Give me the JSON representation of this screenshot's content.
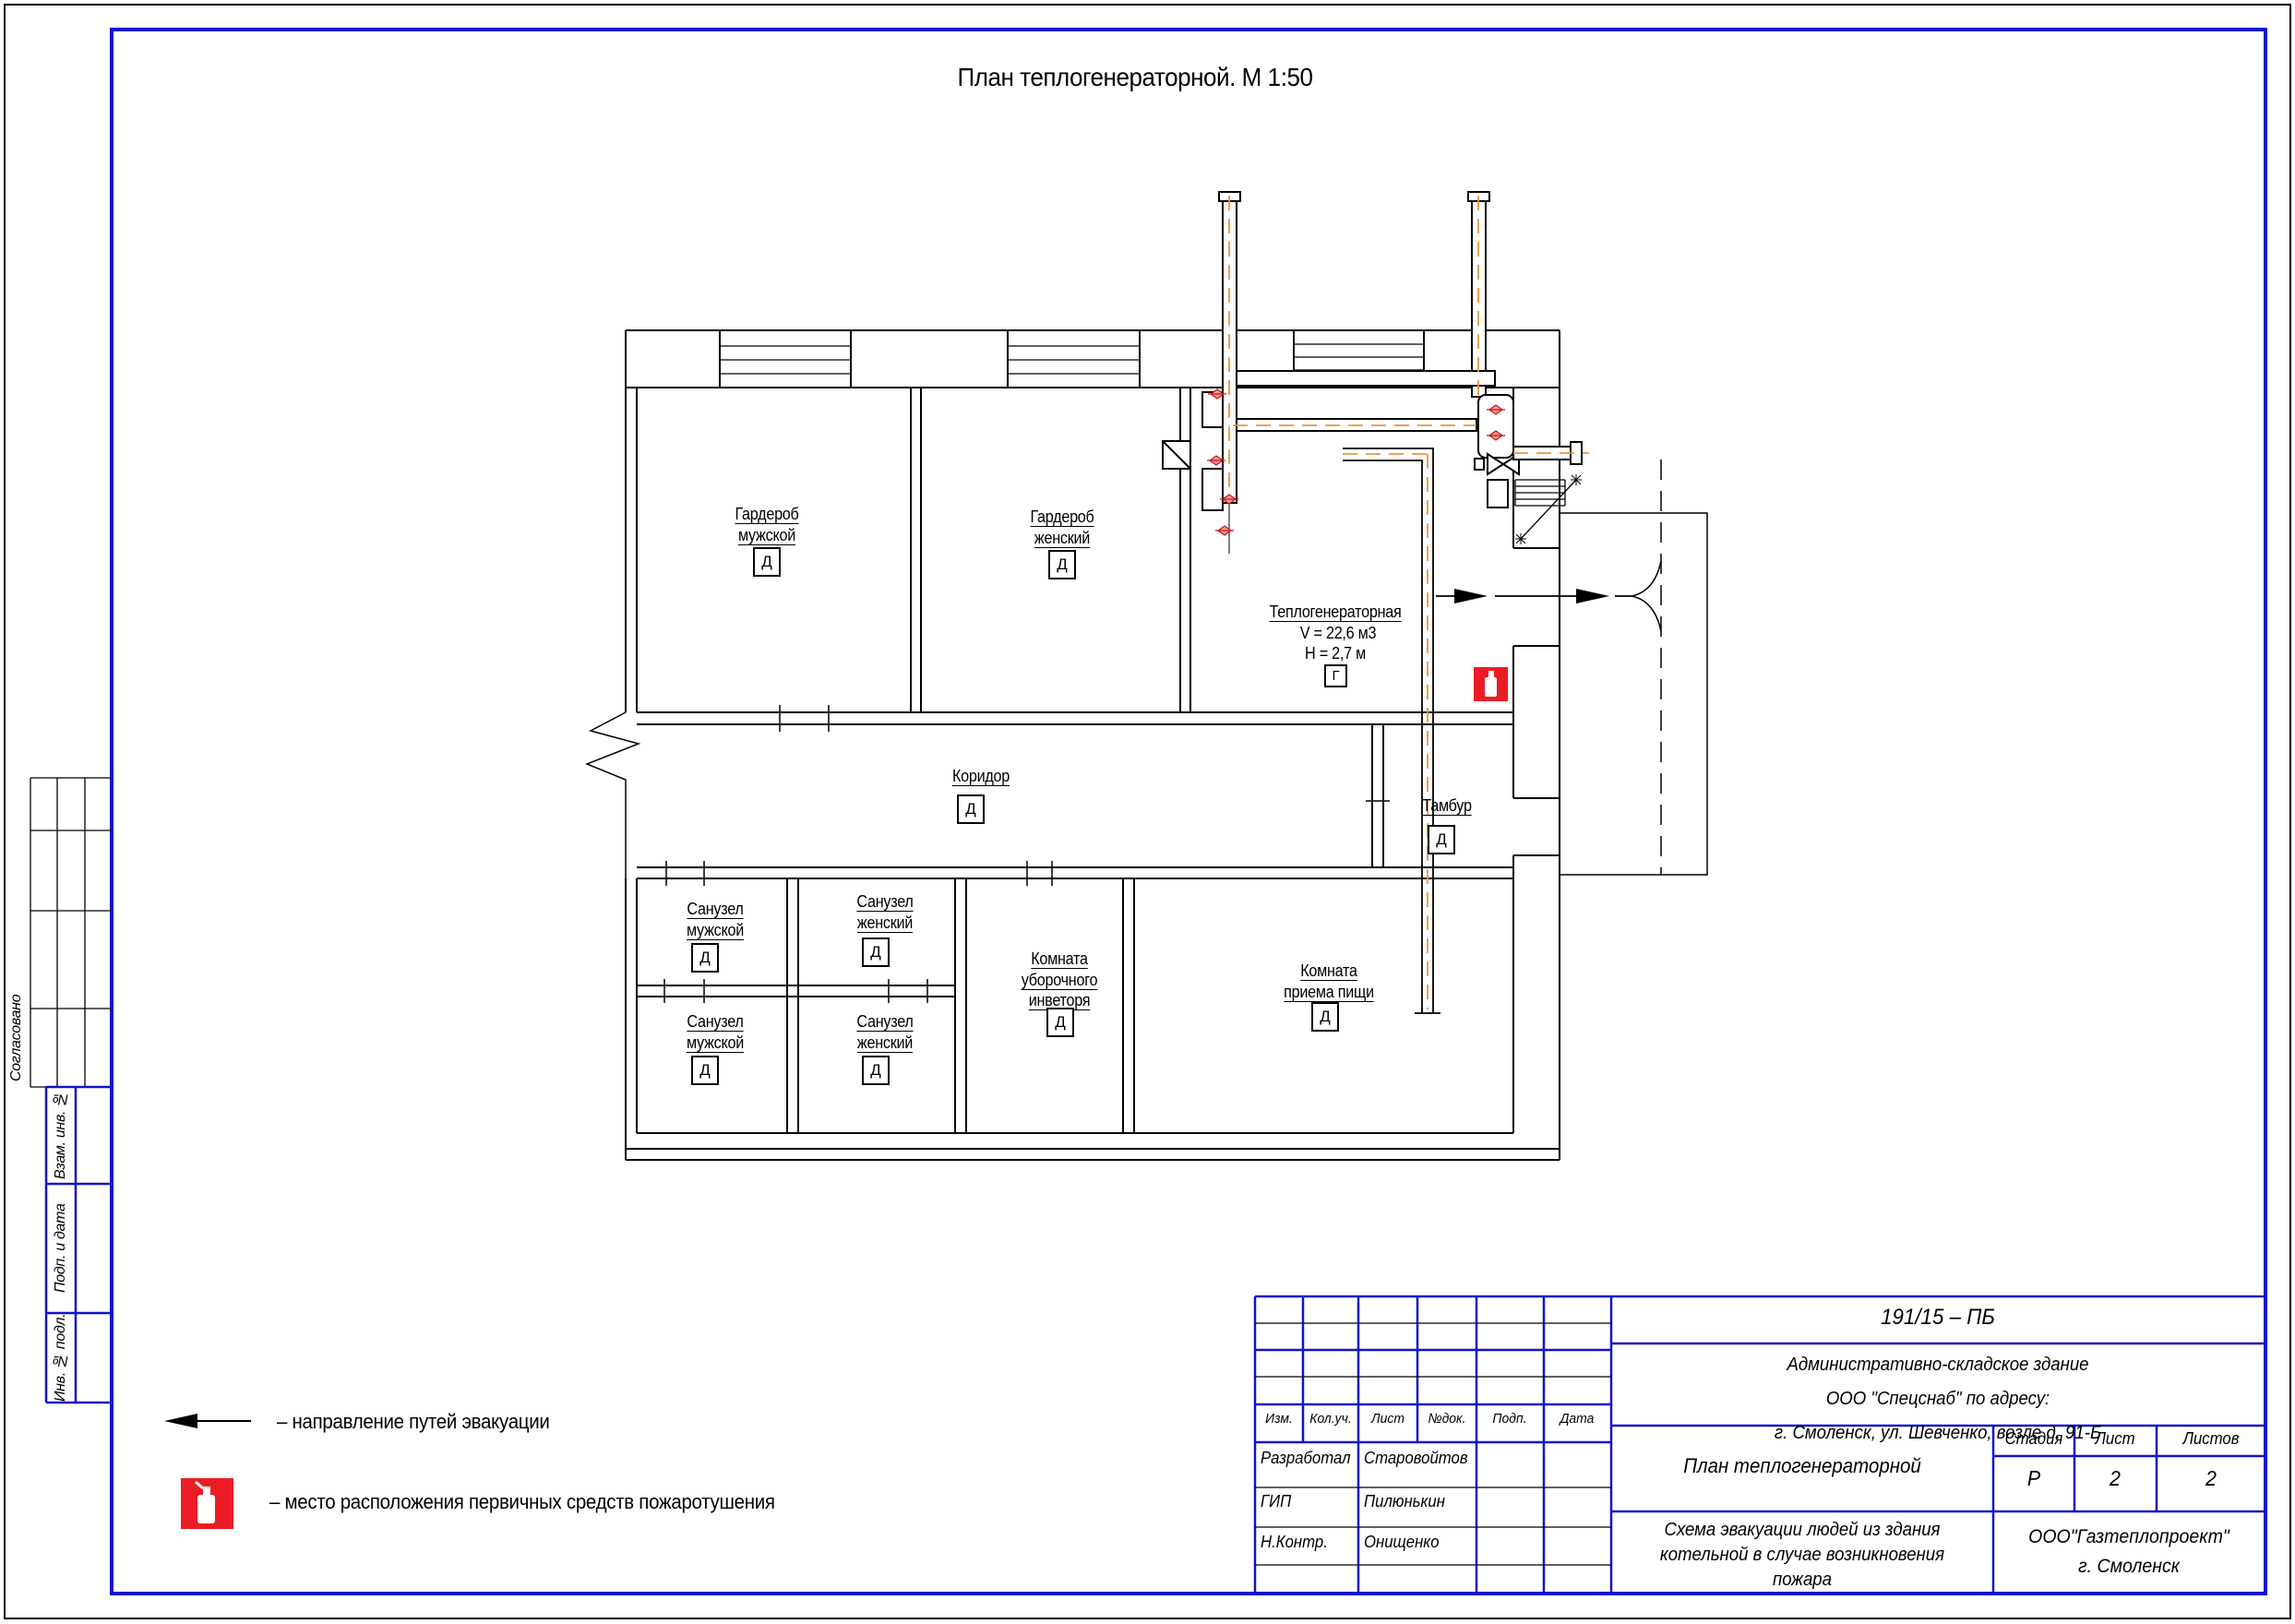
{
  "sheet": {
    "title": "План теплогенераторной. М 1:50"
  },
  "plan": {
    "rooms": [
      {
        "label": "Гардероб\nмужской",
        "category": "Д"
      },
      {
        "label": "Гардероб\nженский",
        "category": "Д"
      },
      {
        "label": "Теплогенераторная",
        "volume": "V = 22,6 м3",
        "height_note": "Н = 2,7 м",
        "category": "Г"
      },
      {
        "label": "Коридор",
        "category": "Д"
      },
      {
        "label": "Тамбур",
        "category": "Д"
      },
      {
        "label": "Санузел\nмужской",
        "category": "Д"
      },
      {
        "label": "Санузел\nженский",
        "category": "Д"
      },
      {
        "label": "Санузел\nмужской",
        "category": "Д"
      },
      {
        "label": "Санузел\nженский",
        "category": "Д"
      },
      {
        "label": "Комната\nуборочного\nинветоря",
        "category": "Д"
      },
      {
        "label": "Комната\nприема пищи",
        "category": "Д"
      }
    ]
  },
  "legend": {
    "evacuation": "– направление путей эвакуации",
    "extinguisher": "– место расположения первичных средств пожаротушения"
  },
  "side_column": {
    "agreed": "Согласовано",
    "vzam": "Взам. инв. №",
    "podp": "Подп. и дата",
    "inv": "Инв. № подл."
  },
  "title_block": {
    "doc_number": "191/15 – ПБ",
    "object": "Административно-складское здание ООО \"Спецснаб\" по адресу:\nг. Смоленск, ул. Шевченко, возле д. 91-Б",
    "sheet_title": "План теплогенераторной",
    "scheme_title": "Схема эвакуации людей из здания\nкотельной в случае возникновения\nпожара",
    "organization": "ООО\"Газтеплопроект\"\nг. Смоленск",
    "cols": {
      "izm": "Изм.",
      "kol": "Кол.уч.",
      "list": "Лист",
      "ndok": "№док.",
      "podp": "Подп.",
      "data": "Дата"
    },
    "roles": [
      {
        "role": "Разработал",
        "name": "Старовойтов"
      },
      {
        "role": "ГИП",
        "name": "Пилюнькин"
      },
      {
        "role": "Н.Контр.",
        "name": "Онищенко"
      }
    ],
    "stage_col": {
      "label": "Стадия",
      "value": "Р"
    },
    "sheet_col": {
      "label": "Лист",
      "value": "2"
    },
    "sheets_col": {
      "label": "Листов",
      "value": "2"
    }
  },
  "colors": {
    "frame_blue": "#1212cc",
    "fire_red": "#ec1c24",
    "pipe_orange": "#e8953c",
    "line_black": "#000000"
  }
}
